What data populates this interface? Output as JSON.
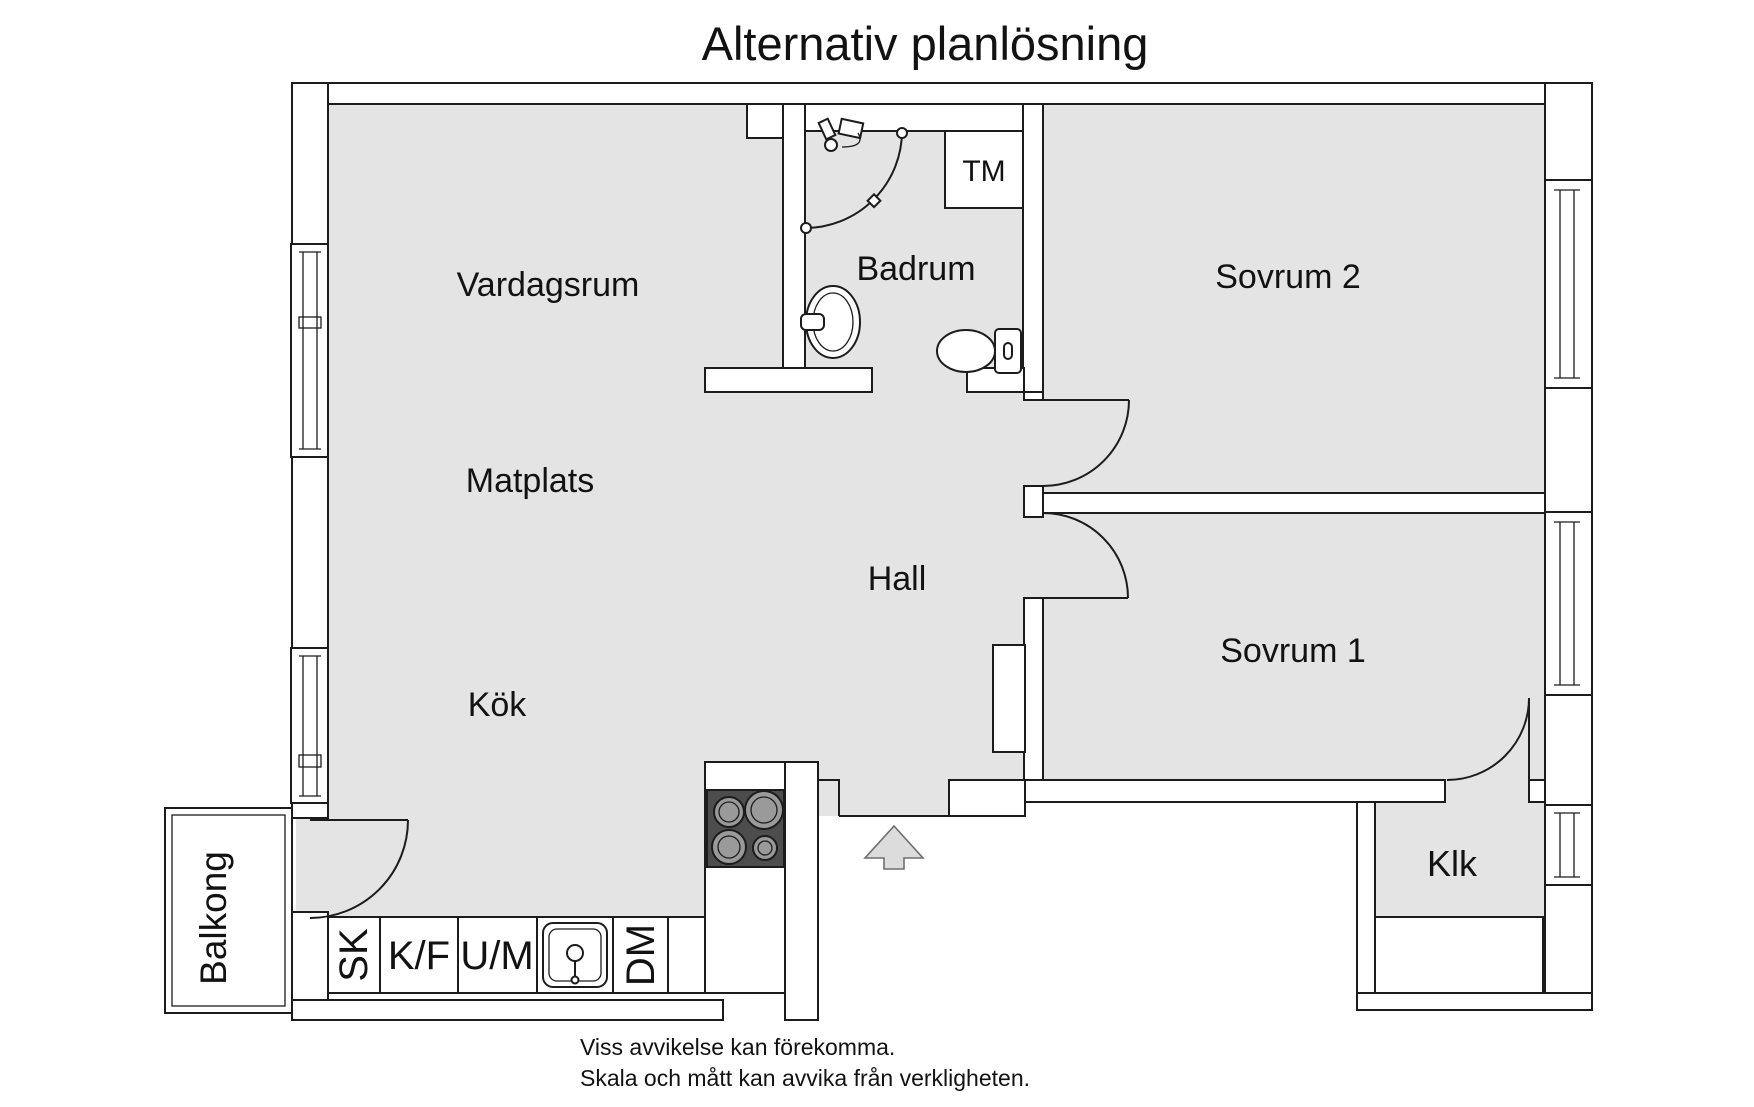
{
  "title": "Alternativ planlösning",
  "rooms": {
    "living": "Vardagsrum",
    "dining": "Matplats",
    "kitchen": "Kök",
    "hall": "Hall",
    "bathroom": "Badrum",
    "bedroom2": "Sovrum 2",
    "bedroom1": "Sovrum 1",
    "closet": "Klk",
    "balcony": "Balkong"
  },
  "appliances": {
    "washing_machine": "TM",
    "tall_cabinet": "SK",
    "fridge_freezer": "K/F",
    "oven_microwave": "U/M",
    "dishwasher": "DM"
  },
  "footer": {
    "line1": "Viss avvikelse kan förekomma.",
    "line2": "Skala och mått kan avvika från verkligheten."
  },
  "colors": {
    "floor": "#e4e4e4",
    "wall": "#ffffff",
    "line": "#1c1c1c",
    "stove": "#4d4d4d",
    "burner": "#9a9a9a",
    "arrow": "#dcdcdc"
  }
}
